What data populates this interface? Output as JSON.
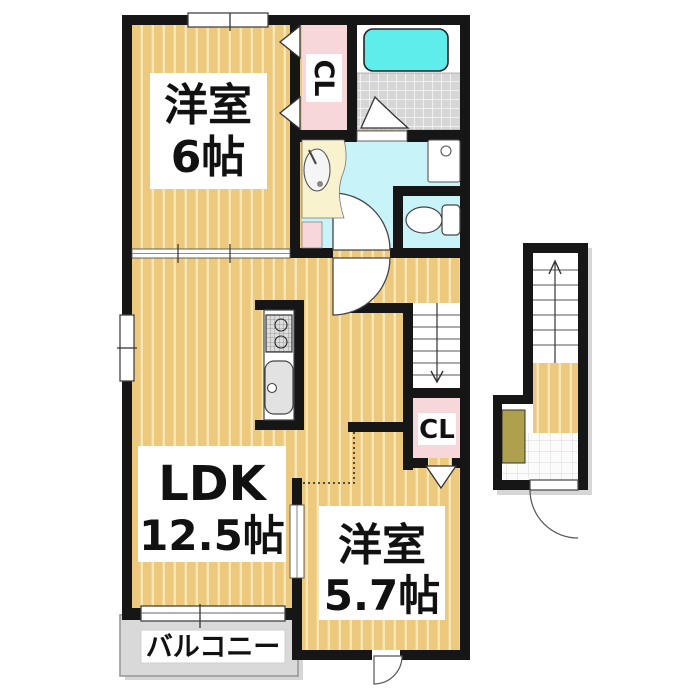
{
  "plan": {
    "room_west_6": {
      "name": "洋室",
      "size": "6帖"
    },
    "ldk": {
      "name": "LDK",
      "size": "12.5帖"
    },
    "room_west_57": {
      "name": "洋室",
      "size": "5.7帖"
    },
    "closet_upper": {
      "label": "CL"
    },
    "closet_lower": {
      "label": "CL"
    },
    "balcony": {
      "label": "バルコニー"
    }
  },
  "colors": {
    "wall": "#161616",
    "floor": "#EDC97D",
    "floorStripe": "#F8E7B6",
    "closet": "#F8D7DB",
    "wet": "#C8F3F8",
    "bathtub": "#5FEDEC",
    "tile": "#D6D6D6",
    "balcony": "#D9D9D9",
    "mat": "#AFA04E",
    "vanity": "#F9F2CF"
  }
}
